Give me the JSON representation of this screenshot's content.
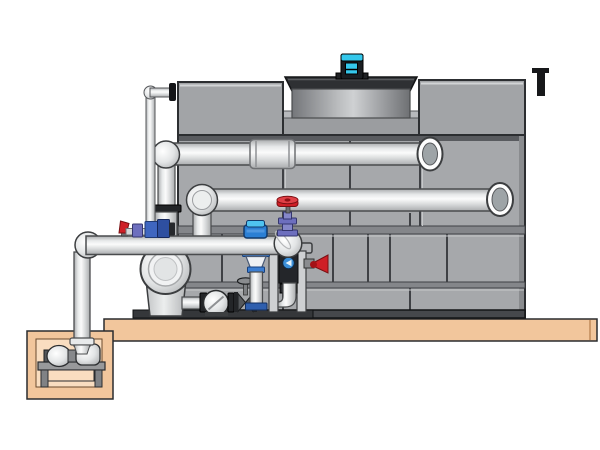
{
  "scene": {
    "type": "technical illustration",
    "subject": "cooling tower with condenser piping, pump skid and sump pit",
    "background_color": "#ffffff",
    "has_text": false
  },
  "components": [
    "cooling-tower-casing",
    "tower-top-boxes",
    "fan-shroud",
    "fan-motor",
    "condenser-supply-pipe",
    "condenser-return-pipe",
    "wall-penetration-collars",
    "make-up-water-line",
    "suction-header-pipe",
    "end-suction-pump",
    "pump-skid-frame",
    "check-valve",
    "gate-valve",
    "globe-valve-red-handwheel",
    "butterfly-valve-lever",
    "suction-diffuser-cone",
    "blue-instrument-cap",
    "equipment-pad",
    "sump-pit",
    "sump-pump"
  ],
  "colors": {
    "tower_face": "#a6a8ab",
    "tower_top_box": "#a2a4a7",
    "tower_seam": "#3f4145",
    "tower_band": "#84868a",
    "tower_base": "#46484c",
    "recess_shadow": "#595b5f",
    "deck_lip": "#b7b9bc",
    "deck_band": "#9b9da0",
    "shroud_dark": "#2e3033",
    "motor_cyan": "#35c8ec",
    "motor_body": "#1b1e22",
    "platform_tan": "#f2c69c",
    "pit_inner_tan": "#f9ddc0",
    "metal_gray": "#98999b",
    "leg_gray": "#808285",
    "flange_dark": "#232528",
    "valve_red": "#cf1f26",
    "valve_red_light": "#e04046",
    "valve_blue": "#3f66c0",
    "valve_blue_dark": "#2e4fa0",
    "valve_purple": "#6d6fbe",
    "valve_purple_light": "#8587c9",
    "instrument_blue": "#2b7fd4",
    "instrument_blue_light": "#4fc3f0",
    "flange_blue": "#3b7ed2",
    "foot_blue": "#2f5fae",
    "panel_dark": "#24262a",
    "sensor_blue": "#3b8fd9"
  }
}
